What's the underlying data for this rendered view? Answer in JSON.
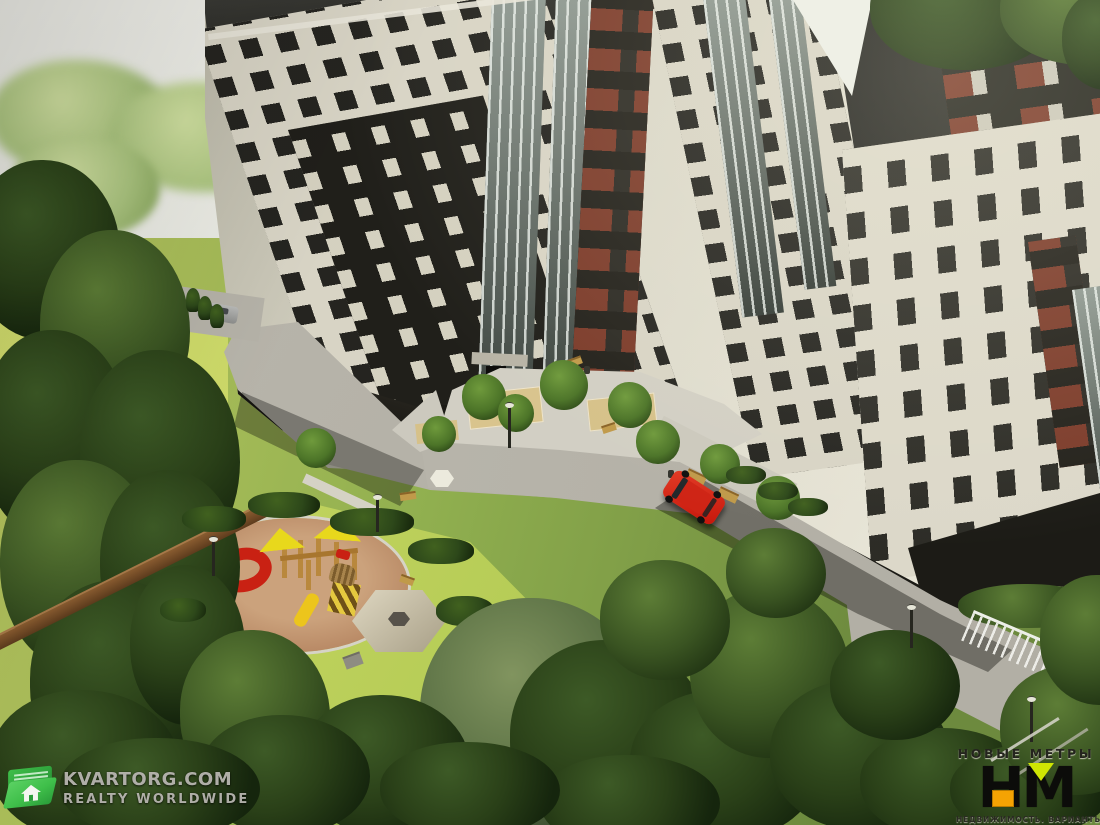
{
  "watermarks": {
    "kvartorg": {
      "brand": "KVARTORG.COM",
      "tagline": "REALTY WORLDWIDE",
      "icon": "folder-house-icon"
    },
    "novye_metry": {
      "brand": "НОВЫЕ МЕТРЫ",
      "monogram_h": "Н",
      "monogram_m": "М",
      "tagline": "НЕДВИЖИМОСТЬ. ВАРИАНТЫ."
    }
  },
  "palette": {
    "sky": "#eceee6",
    "facade_cream": "#d8d4c5",
    "facade_dark": "#201f1a",
    "panel_red": "#7c3b2a",
    "road": "#b6b3a9",
    "pavement": "#cfccc1",
    "grass_bright": "#cdd965",
    "tree_dark": "#263b17",
    "playground_surface": "#b98a66",
    "wood": "#c0903f",
    "canopy_yellow": "#e8d81c",
    "slide_red": "#c92113",
    "car_red": "#c6170c",
    "fence_brown": "#6e4425",
    "fence_white": "#edefe8",
    "kvartorg_green": "#3fbf4a",
    "logo_orange": "#f5a303",
    "logo_chartreuse": "#cfe603",
    "logo_black": "#0c0c0a",
    "watermark_gray": "rgba(204,202,196,0.85)"
  },
  "scene": {
    "description": "Aerial 3D render of a multi-section residential complex with cream and black facades, red-brown accent panels, inner courtyard with playground, gazebo, roads, a red SUV, pine forest and watermarks",
    "objects": [
      "apartment-building-left-wing",
      "apartment-building-center-section",
      "apartment-building-right-wing",
      "courtyard-plaza",
      "asphalt-road",
      "children-playground",
      "red-spiral-slide",
      "yellow-canopy-play-structure",
      "hexagonal-gazebo",
      "red-suv",
      "gray-car",
      "wooden-fence",
      "white-metal-fence",
      "street-lamps",
      "benches",
      "pine-trees",
      "lawn"
    ]
  }
}
